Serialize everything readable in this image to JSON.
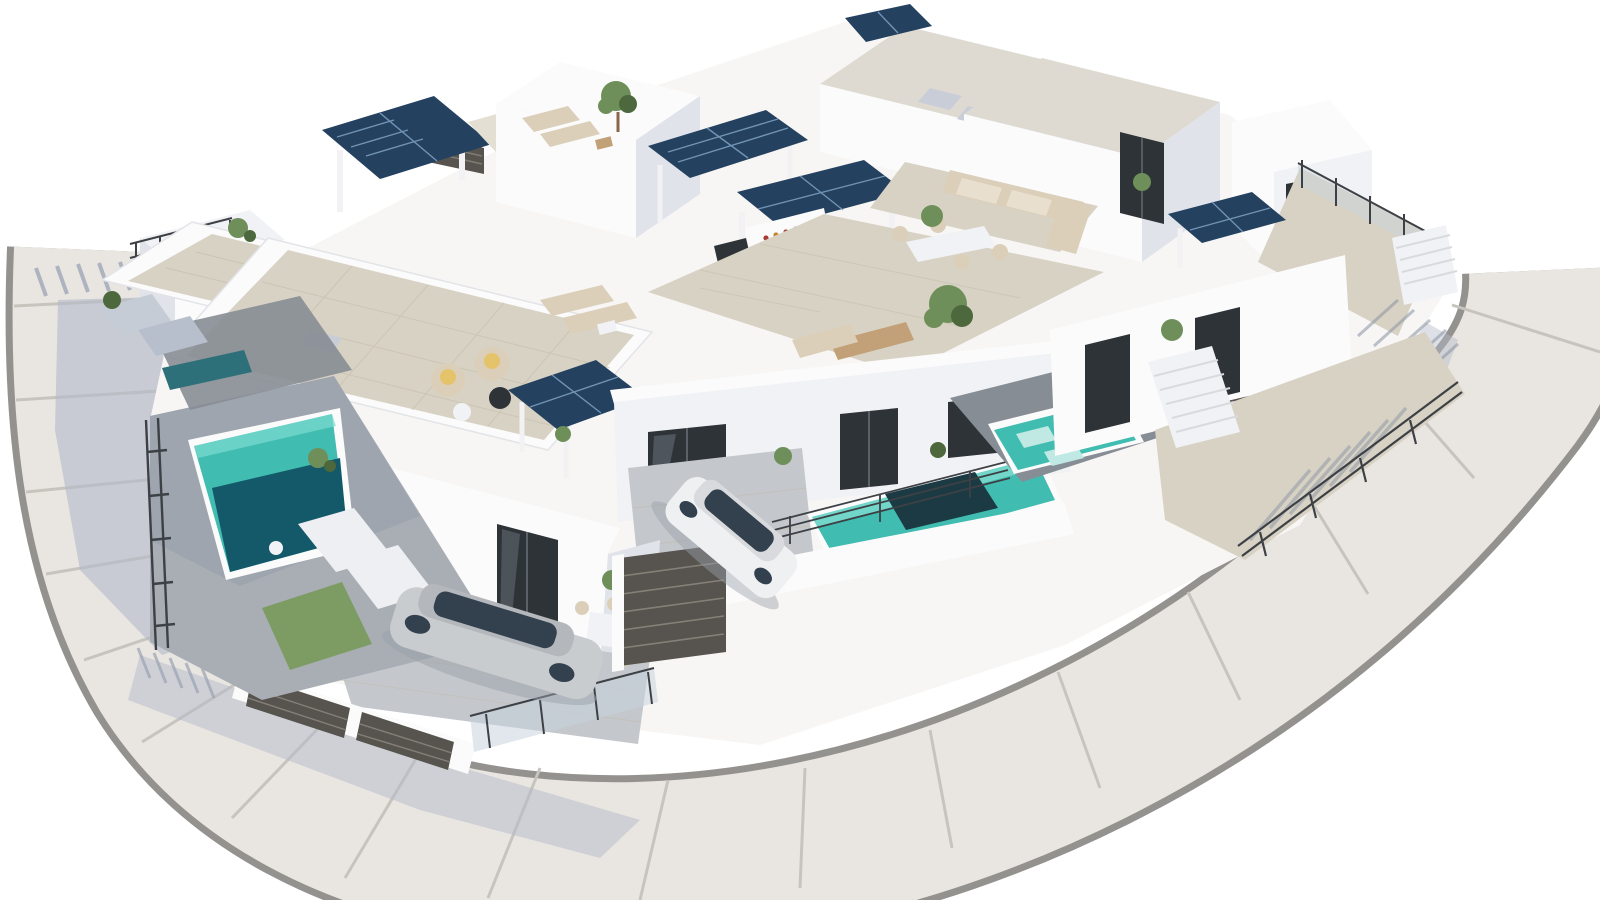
{
  "image": {
    "kind": "3d-architectural-render",
    "description": "Aerial 3D rendering of a modern white residential villa complex on a white background: flat-roofed two-storey villas with beige-tiled roof terraces, dark-blue rooftop solar panel pergolas, private turquoise pools, sun loungers, outdoor lounge and dining furniture, an outdoor kitchen pergola, glass and dark slatted privacy fences, two parked cars, and a light-gray street with a rounded corner wrapping the block on the left and bottom, casting soft blue shadows to the lower left."
  },
  "colors": {
    "bg": "#ffffff",
    "plot_base": "#f7f6f4",
    "road": "#e9e6e1",
    "curb": "#94928e",
    "road_joint": "#c7c4be",
    "shadow_blue": "#b3bac9",
    "wall_white": "#fbfbfc",
    "wall_light": "#f1f2f5",
    "wall_shade": "#e0e3ea",
    "wall_dark": "#c9cdd8",
    "tile_beige": "#d8d2c4",
    "tile_beige_light": "#e4dfd3",
    "tile_grout": "#c2bbaa",
    "gravel": "#dedad1",
    "stone_gray": "#a9aeb4",
    "stone_dark": "#878d95",
    "stone_light": "#c4c8cd",
    "pool_teal": "#41bcb0",
    "pool_teal_light": "#7edcd1",
    "pool_deep": "#14596a",
    "pool_dark_patch": "#1c3a43",
    "pool_shaded": "#2e7079",
    "solar_dark": "#24415f",
    "solar_line": "#7fa2c4",
    "fence_dark": "#57544f",
    "fence_slat": "#8a857c",
    "glass": "#c9d4dc",
    "glass_dark": "#2e3338",
    "metal": "#3d4145",
    "car_silver": "#c9ccce",
    "car_white": "#eef0f1",
    "car_glass": "#33404d",
    "plant_green": "#6f8f5a",
    "plant_dark": "#4c683c",
    "furniture_beige": "#dccfba",
    "furniture_tan": "#c2a078",
    "grass": "#7d9c63",
    "edge_line": "#d9dade"
  },
  "scene": {
    "road": {
      "shape": "curved corner street with expansion joints",
      "sides": [
        "left",
        "bottom"
      ],
      "joints_visible": true
    },
    "villas_visible": 8,
    "solar_panels": 6,
    "pools": 5,
    "cars": [
      {
        "name": "silver-sedan",
        "location": "front-left driveway"
      },
      {
        "name": "white-suv",
        "location": "center driveway"
      }
    ],
    "amenities": [
      "beige-tiled roof terraces",
      "outdoor kitchen pergola with solar roof",
      "corner lounge sofas",
      "outdoor dining sets",
      "wicker armchairs with yellow cushions",
      "sun loungers",
      "in-pool loungers",
      "glass balustrades",
      "dark slatted privacy fences and gates",
      "black metal railings",
      "outdoor shower",
      "potted plants and small trees",
      "external staircases"
    ],
    "lighting": "sun from upper right, soft blue shadows cast to lower left"
  }
}
